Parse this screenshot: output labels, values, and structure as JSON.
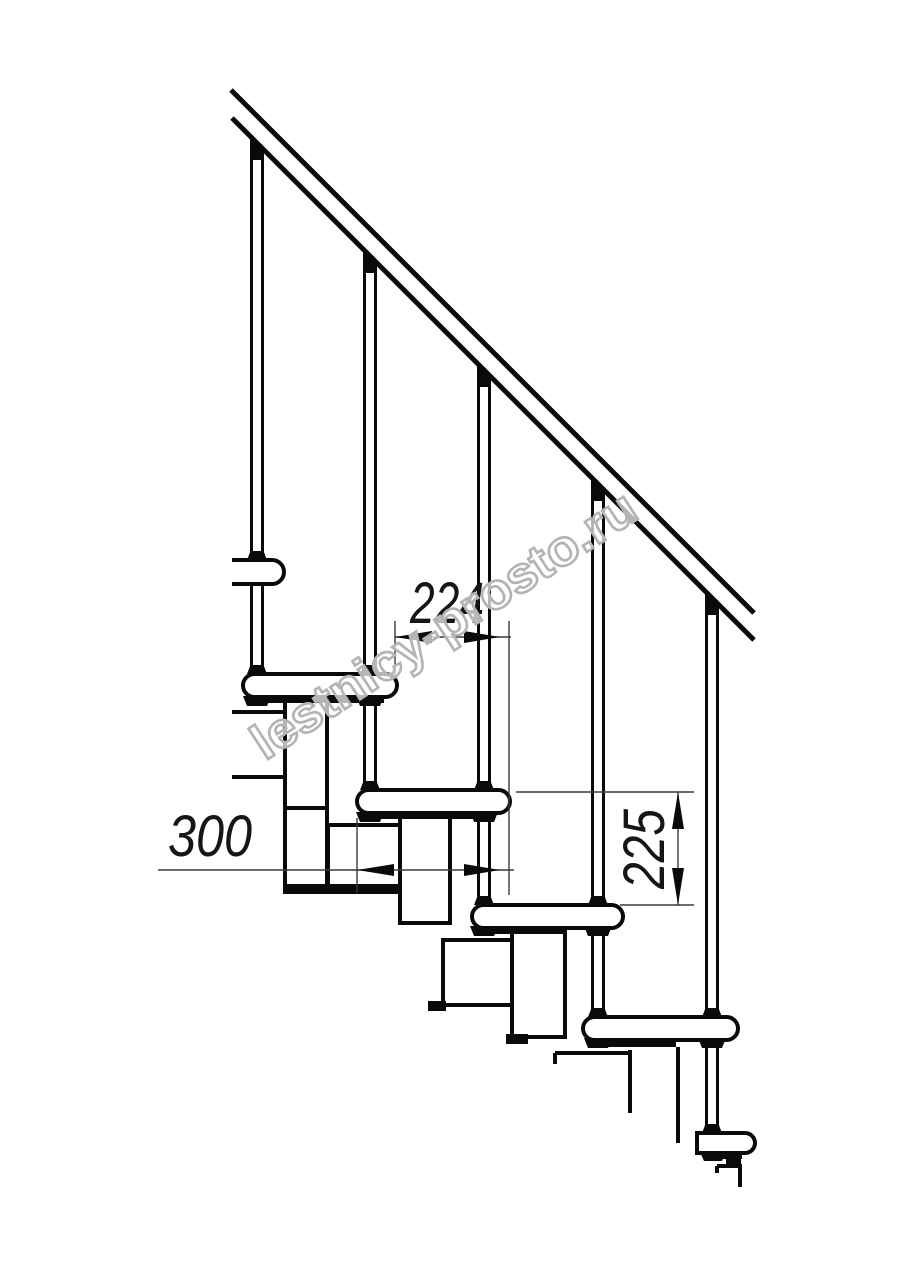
{
  "drawing": {
    "background": "#ffffff",
    "line_color": "#0a0a0a",
    "thin_line_color": "#3a3a3a"
  },
  "dimensions": {
    "step_run_mm": "224",
    "tread_depth_mm": "300",
    "step_rise_mm": "225"
  },
  "watermark": {
    "text": "lestnicy-prosto.ru",
    "color": "#b4b4b4"
  }
}
